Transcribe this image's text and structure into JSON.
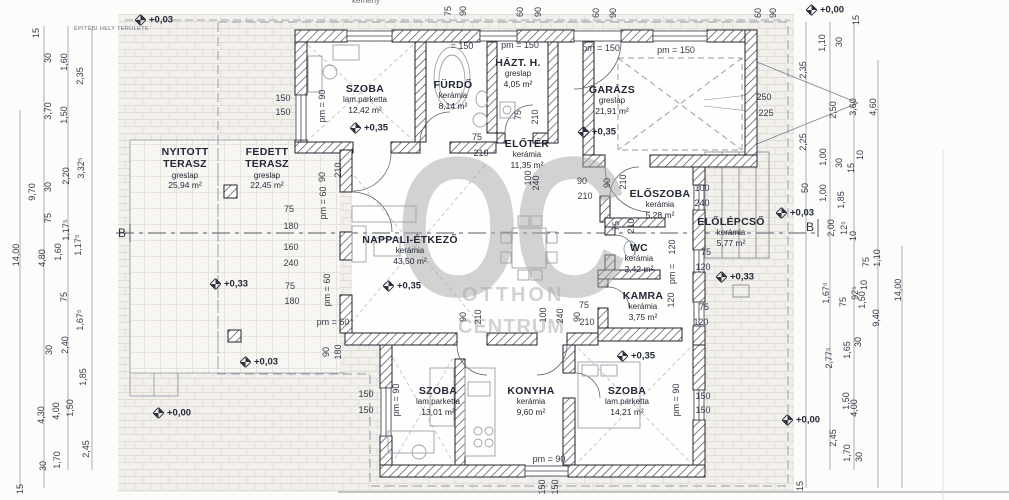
{
  "watermark": {
    "big": "OC",
    "line1": "OTTHON",
    "line2": "CENTRUM"
  },
  "site_label": "ÉPÍTÉSI HELY TERÜLETE",
  "chimney_label": "kémény",
  "section_marker": "B",
  "rooms": [
    {
      "name": "SZOBA",
      "finish": "lam.parketta",
      "area": "12,42 m²",
      "x": 365,
      "y": 99
    },
    {
      "name": "FÜRDŐ",
      "finish": "kerámia",
      "area": "8,14 m²",
      "x": 453,
      "y": 95
    },
    {
      "name": "HÁZT. H.",
      "finish": "greslap",
      "area": "4,05 m²",
      "x": 518,
      "y": 73
    },
    {
      "name": "GARÁZS",
      "finish": "greslap",
      "area": "21,91 m²",
      "x": 612,
      "y": 100
    },
    {
      "name": "NYITOTT\nTERASZ",
      "finish": "greslap",
      "area": "25,94 m²",
      "x": 185,
      "y": 168
    },
    {
      "name": "FEDETT\nTERASZ",
      "finish": "greslap",
      "area": "22,45 m²",
      "x": 267,
      "y": 168
    },
    {
      "name": "ELŐTÉR",
      "finish": "kerámia",
      "area": "11,35 m²",
      "x": 527,
      "y": 154
    },
    {
      "name": "NAPPALI-ÉTKEZŐ",
      "finish": "kerámia",
      "area": "43,50 m²",
      "x": 410,
      "y": 250
    },
    {
      "name": "ELŐSZOBA",
      "finish": "kerámia",
      "area": "5,28 m²",
      "x": 660,
      "y": 204
    },
    {
      "name": "ELŐLÉPCSŐ",
      "finish": "kerámia",
      "area": "5,77 m²",
      "x": 731,
      "y": 232
    },
    {
      "name": "WC",
      "finish": "kerámia",
      "area": "2,42 m²",
      "x": 639,
      "y": 258
    },
    {
      "name": "KAMRA",
      "finish": "kerámia",
      "area": "3,75 m²",
      "x": 643,
      "y": 306
    },
    {
      "name": "SZOBA",
      "finish": "lam.parketta",
      "area": "13,01 m²",
      "x": 438,
      "y": 401
    },
    {
      "name": "KONYHA",
      "finish": "kerámia",
      "area": "9,60 m²",
      "x": 531,
      "y": 401
    },
    {
      "name": "SZOBA",
      "finish": "lam.parketta",
      "area": "14,21 m²",
      "x": 627,
      "y": 401
    }
  ],
  "level_markers": [
    {
      "text": "+0,03",
      "x": 135,
      "y": 20
    },
    {
      "text": "+0,00",
      "x": 806,
      "y": 10
    },
    {
      "text": "+0,35",
      "x": 350,
      "y": 128
    },
    {
      "text": "+0,35",
      "x": 578,
      "y": 132
    },
    {
      "text": "+0,35",
      "x": 383,
      "y": 286
    },
    {
      "text": "+0,33",
      "x": 210,
      "y": 284
    },
    {
      "text": "+0,03",
      "x": 240,
      "y": 362
    },
    {
      "text": "+0,00",
      "x": 153,
      "y": 413
    },
    {
      "text": "+0,35",
      "x": 617,
      "y": 356
    },
    {
      "text": "+0,33",
      "x": 716,
      "y": 277
    },
    {
      "text": "+0,03",
      "x": 776,
      "y": 213
    },
    {
      "text": "+0,00",
      "x": 782,
      "y": 420
    }
  ],
  "dim_labels": [
    {
      "t": "15",
      "x": 36,
      "y": 33,
      "r": -90
    },
    {
      "t": "30",
      "x": 48,
      "y": 58,
      "r": -90
    },
    {
      "t": "1,60",
      "x": 64,
      "y": 62,
      "r": -90
    },
    {
      "t": "2,35",
      "x": 80,
      "y": 76,
      "r": -90
    },
    {
      "t": "3,70",
      "x": 48,
      "y": 111,
      "r": -90
    },
    {
      "t": "1,50",
      "x": 64,
      "y": 115,
      "r": -90
    },
    {
      "t": "9,70",
      "x": 32,
      "y": 192,
      "r": -90
    },
    {
      "t": "30",
      "x": 48,
      "y": 187,
      "r": -90
    },
    {
      "t": "2,20",
      "x": 66,
      "y": 176,
      "r": -90
    },
    {
      "t": "3,32⁵",
      "x": 81,
      "y": 168,
      "r": -90
    },
    {
      "t": "75",
      "x": 48,
      "y": 218,
      "r": -90
    },
    {
      "t": "1,17⁵",
      "x": 66,
      "y": 230,
      "r": -90
    },
    {
      "t": "14,00",
      "x": 16,
      "y": 255,
      "r": -90
    },
    {
      "t": "4,80",
      "x": 42,
      "y": 258,
      "r": -90
    },
    {
      "t": "1,60",
      "x": 58,
      "y": 252,
      "r": -90
    },
    {
      "t": "1,17⁵",
      "x": 78,
      "y": 245,
      "r": -90
    },
    {
      "t": "75",
      "x": 64,
      "y": 297,
      "r": -90
    },
    {
      "t": "1,67⁵",
      "x": 80,
      "y": 320,
      "r": -90
    },
    {
      "t": "30",
      "x": 49,
      "y": 350,
      "r": -90
    },
    {
      "t": "2,40",
      "x": 65,
      "y": 345,
      "r": -90
    },
    {
      "t": "1,85",
      "x": 83,
      "y": 377,
      "r": -90
    },
    {
      "t": "4,30",
      "x": 41,
      "y": 415,
      "r": -90
    },
    {
      "t": "4,00",
      "x": 56,
      "y": 411,
      "r": -90
    },
    {
      "t": "1,50",
      "x": 70,
      "y": 408,
      "r": -90
    },
    {
      "t": "1,70",
      "x": 57,
      "y": 460,
      "r": -90
    },
    {
      "t": "2,45",
      "x": 86,
      "y": 449,
      "r": -90
    },
    {
      "t": "30",
      "x": 43,
      "y": 466,
      "r": -90
    },
    {
      "t": "15",
      "x": 20,
      "y": 489,
      "r": -90
    },
    {
      "t": "75",
      "x": 448,
      "y": 11,
      "r": -90
    },
    {
      "t": "90",
      "x": 463,
      "y": 11,
      "r": -90
    },
    {
      "t": "60",
      "x": 520,
      "y": 12,
      "r": -90
    },
    {
      "t": "90",
      "x": 538,
      "y": 12,
      "r": -90
    },
    {
      "t": "60",
      "x": 596,
      "y": 13,
      "r": -90
    },
    {
      "t": "90",
      "x": 613,
      "y": 13,
      "r": -90
    },
    {
      "t": "60",
      "x": 758,
      "y": 13,
      "r": -90
    },
    {
      "t": "90",
      "x": 773,
      "y": 13,
      "r": -90
    },
    {
      "t": "= 150",
      "x": 462,
      "y": 46
    },
    {
      "t": "pm = 150",
      "x": 520,
      "y": 45
    },
    {
      "t": "pm = 150",
      "x": 601,
      "y": 48
    },
    {
      "t": "pm = 150",
      "x": 676,
      "y": 50
    },
    {
      "t": "150",
      "x": 283,
      "y": 98
    },
    {
      "t": "150",
      "x": 283,
      "y": 112
    },
    {
      "t": "pm = 90",
      "x": 322,
      "y": 106,
      "r": -90
    },
    {
      "t": "210",
      "x": 338,
      "y": 170,
      "r": -90
    },
    {
      "t": "90",
      "x": 322,
      "y": 177,
      "r": -90
    },
    {
      "t": "pm = 60",
      "x": 323,
      "y": 203,
      "r": -90
    },
    {
      "t": "75",
      "x": 289,
      "y": 209
    },
    {
      "t": "180",
      "x": 291,
      "y": 226
    },
    {
      "t": "160",
      "x": 291,
      "y": 247
    },
    {
      "t": "240",
      "x": 291,
      "y": 263
    },
    {
      "t": "75",
      "x": 290,
      "y": 286
    },
    {
      "t": "180",
      "x": 292,
      "y": 301
    },
    {
      "t": "pm = 60",
      "x": 333,
      "y": 322
    },
    {
      "t": "pm = 60",
      "x": 327,
      "y": 290,
      "r": -90
    },
    {
      "t": "90",
      "x": 326,
      "y": 352,
      "r": -90
    },
    {
      "t": "180",
      "x": 338,
      "y": 352,
      "r": -90
    },
    {
      "t": "75",
      "x": 477,
      "y": 137
    },
    {
      "t": "210",
      "x": 481,
      "y": 153
    },
    {
      "t": "75",
      "x": 518,
      "y": 115,
      "r": -90
    },
    {
      "t": "210",
      "x": 535,
      "y": 117,
      "r": -90
    },
    {
      "t": "90",
      "x": 582,
      "y": 181
    },
    {
      "t": "210",
      "x": 585,
      "y": 196
    },
    {
      "t": "100",
      "x": 528,
      "y": 178,
      "r": -90
    },
    {
      "t": "240",
      "x": 536,
      "y": 183,
      "r": -90
    },
    {
      "t": "90",
      "x": 607,
      "y": 183,
      "r": -90
    },
    {
      "t": "210",
      "x": 623,
      "y": 182,
      "r": -90
    },
    {
      "t": "75",
      "x": 616,
      "y": 226,
      "r": -90
    },
    {
      "t": "210",
      "x": 631,
      "y": 226,
      "r": -90
    },
    {
      "t": "90",
      "x": 463,
      "y": 317,
      "r": -90
    },
    {
      "t": "210",
      "x": 478,
      "y": 317,
      "r": -90
    },
    {
      "t": "100",
      "x": 543,
      "y": 315,
      "r": -90
    },
    {
      "t": "240",
      "x": 560,
      "y": 316,
      "r": -90
    },
    {
      "t": "90",
      "x": 577,
      "y": 317,
      "r": -90
    },
    {
      "t": "75",
      "x": 584,
      "y": 305
    },
    {
      "t": "210",
      "x": 587,
      "y": 322
    },
    {
      "t": "100",
      "x": 702,
      "y": 188
    },
    {
      "t": "240",
      "x": 702,
      "y": 203
    },
    {
      "t": "75",
      "x": 706,
      "y": 252
    },
    {
      "t": "120",
      "x": 703,
      "y": 267
    },
    {
      "t": "75",
      "x": 704,
      "y": 307
    },
    {
      "t": "120",
      "x": 701,
      "y": 322
    },
    {
      "t": "120",
      "x": 672,
      "y": 247,
      "r": -90
    },
    {
      "t": "pm =",
      "x": 672,
      "y": 274,
      "r": -90
    },
    {
      "t": "120",
      "x": 671,
      "y": 300,
      "r": -90
    },
    {
      "t": "150",
      "x": 703,
      "y": 396
    },
    {
      "t": "150",
      "x": 703,
      "y": 410
    },
    {
      "t": "pm = 90",
      "x": 676,
      "y": 400,
      "r": -90
    },
    {
      "t": "150",
      "x": 366,
      "y": 394
    },
    {
      "t": "150",
      "x": 366,
      "y": 410
    },
    {
      "t": "pm = 90",
      "x": 396,
      "y": 400,
      "r": -90
    },
    {
      "t": "pm = 90",
      "x": 549,
      "y": 459
    },
    {
      "t": "150",
      "x": 542,
      "y": 487,
      "r": -90
    },
    {
      "t": "150",
      "x": 555,
      "y": 487,
      "r": -90
    },
    {
      "t": "250",
      "x": 764,
      "y": 97
    },
    {
      "t": "225",
      "x": 766,
      "y": 113
    },
    {
      "t": "15",
      "x": 856,
      "y": 20,
      "r": -90
    },
    {
      "t": "30",
      "x": 839,
      "y": 42,
      "r": -90
    },
    {
      "t": "1,10",
      "x": 822,
      "y": 43,
      "r": -90
    },
    {
      "t": "2,35",
      "x": 803,
      "y": 70,
      "r": -90
    },
    {
      "t": "2,50",
      "x": 833,
      "y": 110,
      "r": -90
    },
    {
      "t": "3,60",
      "x": 853,
      "y": 107,
      "r": -90
    },
    {
      "t": "4,60",
      "x": 873,
      "y": 107,
      "r": -90
    },
    {
      "t": "2,25",
      "x": 803,
      "y": 142,
      "r": -90
    },
    {
      "t": "1,00",
      "x": 823,
      "y": 157,
      "r": -90
    },
    {
      "t": "30",
      "x": 839,
      "y": 163,
      "r": -90
    },
    {
      "t": "15",
      "x": 851,
      "y": 168,
      "r": -90
    },
    {
      "t": "10",
      "x": 860,
      "y": 155,
      "r": -90
    },
    {
      "t": "50",
      "x": 805,
      "y": 188,
      "r": -90
    },
    {
      "t": "1,00",
      "x": 823,
      "y": 193,
      "r": -90
    },
    {
      "t": "1,85",
      "x": 841,
      "y": 200,
      "r": -90
    },
    {
      "t": "2,00",
      "x": 831,
      "y": 228,
      "r": -90
    },
    {
      "t": "12⁵",
      "x": 844,
      "y": 228,
      "r": -90
    },
    {
      "t": "10",
      "x": 853,
      "y": 236,
      "r": -90
    },
    {
      "t": "1,67⁵",
      "x": 826,
      "y": 293,
      "r": -90
    },
    {
      "t": "75",
      "x": 843,
      "y": 302,
      "r": -90
    },
    {
      "t": "92⁵",
      "x": 855,
      "y": 293,
      "r": -90
    },
    {
      "t": "10",
      "x": 864,
      "y": 285,
      "r": -90
    },
    {
      "t": "75",
      "x": 866,
      "y": 262,
      "r": -90
    },
    {
      "t": "1,10",
      "x": 877,
      "y": 258,
      "r": -90
    },
    {
      "t": "1,50",
      "x": 862,
      "y": 300,
      "r": -90
    },
    {
      "t": "2,77⁵",
      "x": 829,
      "y": 358,
      "r": -90
    },
    {
      "t": "1,65",
      "x": 847,
      "y": 350,
      "r": -90
    },
    {
      "t": "30",
      "x": 858,
      "y": 342,
      "r": -90
    },
    {
      "t": "9,40",
      "x": 876,
      "y": 318,
      "r": -90
    },
    {
      "t": "14,00",
      "x": 898,
      "y": 290,
      "r": -90
    },
    {
      "t": "1,50",
      "x": 846,
      "y": 401,
      "r": -90
    },
    {
      "t": "4,00",
      "x": 854,
      "y": 408,
      "r": -90
    },
    {
      "t": "2,45",
      "x": 833,
      "y": 438,
      "r": -90
    },
    {
      "t": "1,70",
      "x": 847,
      "y": 453,
      "r": -90
    },
    {
      "t": "30",
      "x": 859,
      "y": 457,
      "r": -90
    },
    {
      "t": "15",
      "x": 800,
      "y": 486,
      "r": -90
    }
  ]
}
